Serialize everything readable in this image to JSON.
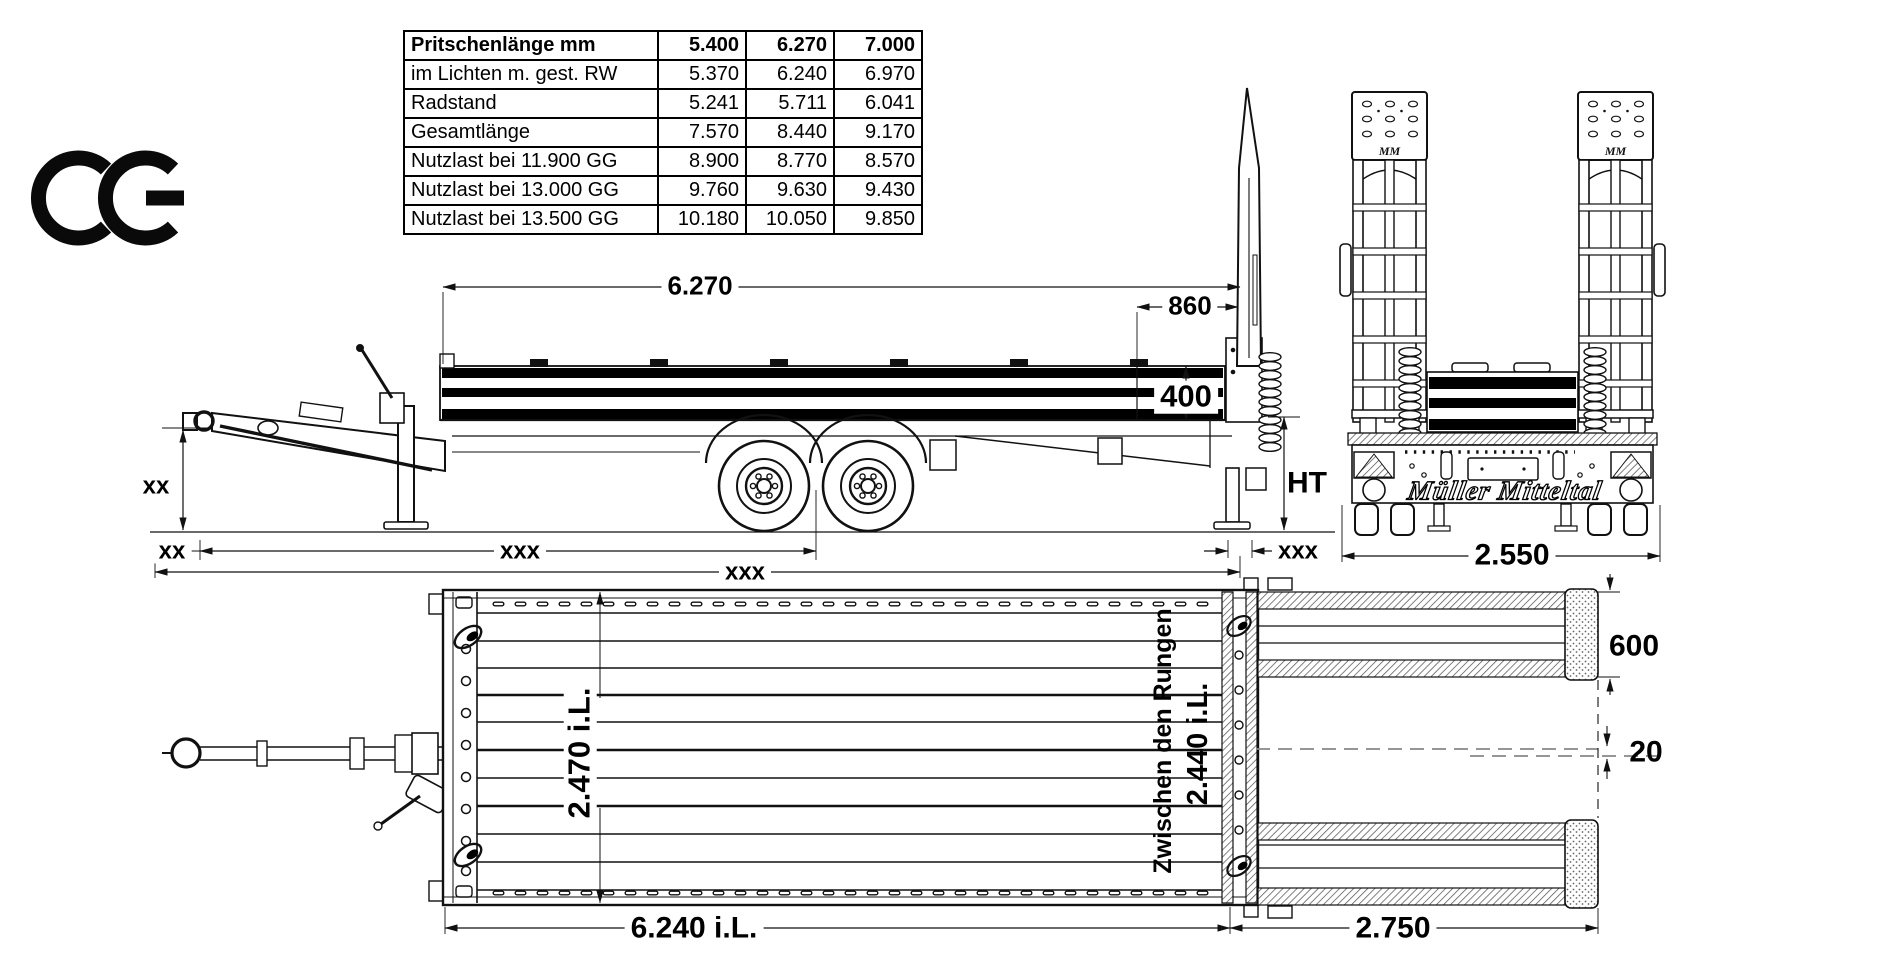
{
  "title": "Tandem low-loader trailer technical drawing",
  "branding": {
    "ce_mark": "CE",
    "logo": "Müller Mitteltal",
    "plate_mark": "MM"
  },
  "icons": {
    "ce_mark": "ce-certification-mark",
    "lashing_ring": "tie-down-ring",
    "coil_spring": "ramp-spring"
  },
  "spec_table": {
    "header": {
      "label": "Pritschenlänge mm",
      "values": [
        "5.400",
        "6.270",
        "7.000"
      ]
    },
    "rows": [
      {
        "label": "im Lichten m. gest. RW",
        "values": [
          "5.370",
          "6.240",
          "6.970"
        ]
      },
      {
        "label": "Radstand",
        "values": [
          "5.241",
          "5.711",
          "6.041"
        ]
      },
      {
        "label": "Gesamtlänge",
        "values": [
          "7.570",
          "8.440",
          "9.170"
        ]
      },
      {
        "label": "Nutzlast bei 11.900 GG",
        "values": [
          "8.900",
          "8.770",
          "8.570"
        ]
      },
      {
        "label": "Nutzlast bei 13.000 GG",
        "values": [
          "9.760",
          "9.630",
          "9.430"
        ]
      },
      {
        "label": "Nutzlast bei 13.500 GG",
        "values": [
          "10.180",
          "10.050",
          "9.850"
        ]
      }
    ]
  },
  "labels": {
    "platform_length": "6.270",
    "ramp_offset": "860",
    "board_height": "400",
    "loading_height": "HT",
    "drawbar_height": "xx",
    "front_overhang": "xx",
    "axle_distance": "xxx",
    "total_length": "xxx",
    "rear_overhang": "xxx",
    "rear_width": "2.550",
    "inner_width": "2.470 i.L.",
    "between_stakes": "Zwischen den Rungen",
    "between_stakes_width": "2.440 i.L.",
    "inner_length": "6.240 i.L.",
    "ramp_length": "2.750",
    "ramp_width": "600",
    "ramp_gap": "20"
  }
}
